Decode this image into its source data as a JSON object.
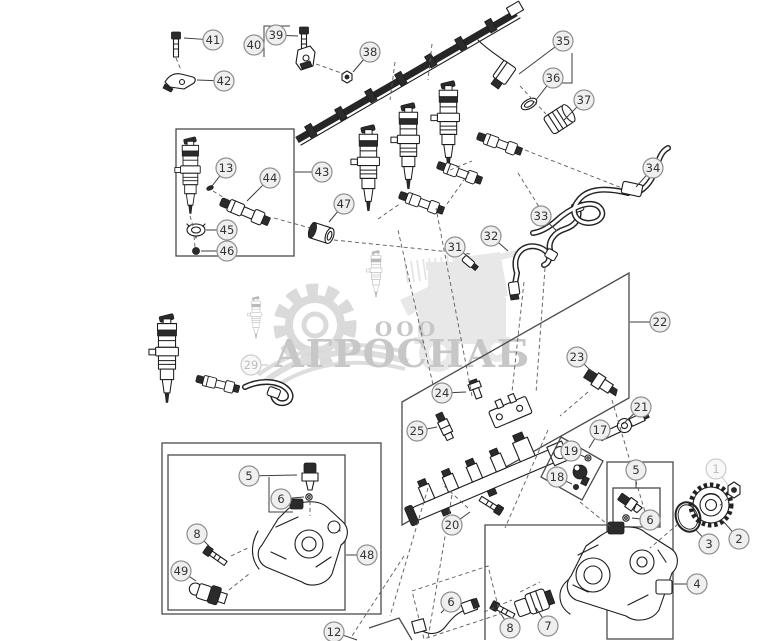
{
  "watermark": {
    "ooo": "ООО",
    "name": "АГРОСНАБ"
  },
  "callout_style": {
    "radius": 10,
    "fill": "#efefef",
    "stroke": "#8f8f8f",
    "text": "#333333"
  },
  "callouts": [
    {
      "n": "41",
      "x": 213,
      "y": 40,
      "lx": 184,
      "ly": 38
    },
    {
      "n": "42",
      "x": 224,
      "y": 81,
      "lx": 197,
      "ly": 80
    },
    {
      "n": "40",
      "x": 254,
      "y": 45,
      "lx": 263,
      "ly": 45
    },
    {
      "n": "39",
      "x": 276,
      "y": 35,
      "lx": 298,
      "ly": 36
    },
    {
      "n": "38",
      "x": 370,
      "y": 52,
      "lx": 353,
      "ly": 72
    },
    {
      "n": "35",
      "x": 563,
      "y": 41,
      "lx": 519,
      "ly": 74
    },
    {
      "n": "36",
      "x": 553,
      "y": 78,
      "lx": 536,
      "ly": 100
    },
    {
      "n": "37",
      "x": 584,
      "y": 100,
      "lx": 564,
      "ly": 120
    },
    {
      "n": "43",
      "x": 322,
      "y": 172,
      "lx": 295,
      "ly": 172
    },
    {
      "n": "13",
      "x": 226,
      "y": 168,
      "lx": 212,
      "ly": 186
    },
    {
      "n": "44",
      "x": 270,
      "y": 178,
      "lx": 247,
      "ly": 201
    },
    {
      "n": "45",
      "x": 227,
      "y": 230,
      "lx": 206,
      "ly": 230
    },
    {
      "n": "46",
      "x": 227,
      "y": 251,
      "lx": 201,
      "ly": 251
    },
    {
      "n": "47",
      "x": 344,
      "y": 204,
      "lx": 329,
      "ly": 222
    },
    {
      "n": "34",
      "x": 653,
      "y": 168,
      "lx": 636,
      "ly": 187
    },
    {
      "n": "33",
      "x": 541,
      "y": 216,
      "lx": 557,
      "ly": 231
    },
    {
      "n": "32",
      "x": 491,
      "y": 236,
      "lx": 508,
      "ly": 251
    },
    {
      "n": "31",
      "x": 455,
      "y": 247,
      "lx": 469,
      "ly": 257
    },
    {
      "n": "29",
      "x": 251,
      "y": 365,
      "lx": 268,
      "ly": 365,
      "faded": true
    },
    {
      "n": "22",
      "x": 660,
      "y": 322,
      "lx": 630,
      "ly": 322
    },
    {
      "n": "23",
      "x": 577,
      "y": 357,
      "lx": 593,
      "ly": 373
    },
    {
      "n": "24",
      "x": 442,
      "y": 393,
      "lx": 466,
      "ly": 392
    },
    {
      "n": "25",
      "x": 417,
      "y": 431,
      "lx": 437,
      "ly": 427
    },
    {
      "n": "21",
      "x": 641,
      "y": 407,
      "lx": 623,
      "ly": 424
    },
    {
      "n": "20",
      "x": 452,
      "y": 525,
      "lx": 470,
      "ly": 512
    },
    {
      "n": "17",
      "x": 600,
      "y": 430,
      "lx": 589,
      "ly": 448
    },
    {
      "n": "19",
      "x": 571,
      "y": 451,
      "lx": 585,
      "ly": 457
    },
    {
      "n": "18",
      "x": 557,
      "y": 477,
      "lx": 572,
      "ly": 484
    },
    {
      "n": "48",
      "x": 367,
      "y": 555,
      "lx": 346,
      "ly": 555
    },
    {
      "n": "5",
      "x": 249,
      "y": 476,
      "lx": 297,
      "ly": 475
    },
    {
      "n": "6",
      "x": 281,
      "y": 499,
      "lx": 304,
      "ly": 497
    },
    {
      "n": "8",
      "x": 197,
      "y": 534,
      "lx": 210,
      "ly": 547
    },
    {
      "n": "49",
      "x": 181,
      "y": 571,
      "lx": 196,
      "ly": 581
    },
    {
      "n": "12",
      "x": 334,
      "y": 632,
      "lx": 357,
      "ly": 640
    },
    {
      "n": "6",
      "x": 451,
      "y": 602,
      "lx": 441,
      "ly": 613
    },
    {
      "n": "8",
      "x": 510,
      "y": 628,
      "lx": 501,
      "ly": 614
    },
    {
      "n": "7",
      "x": 548,
      "y": 626,
      "lx": 536,
      "ly": 608
    },
    {
      "n": "4",
      "x": 697,
      "y": 584,
      "lx": 674,
      "ly": 584
    },
    {
      "n": "5",
      "x": 636,
      "y": 470,
      "lx": 636,
      "ly": 486
    },
    {
      "n": "6",
      "x": 650,
      "y": 520,
      "lx": 632,
      "ly": 518
    },
    {
      "n": "3",
      "x": 709,
      "y": 544,
      "lx": 695,
      "ly": 529
    },
    {
      "n": "2",
      "x": 739,
      "y": 539,
      "lx": 723,
      "ly": 521
    },
    {
      "n": "1",
      "x": 716,
      "y": 469,
      "lx": 728,
      "ly": 485,
      "faded": true
    }
  ]
}
